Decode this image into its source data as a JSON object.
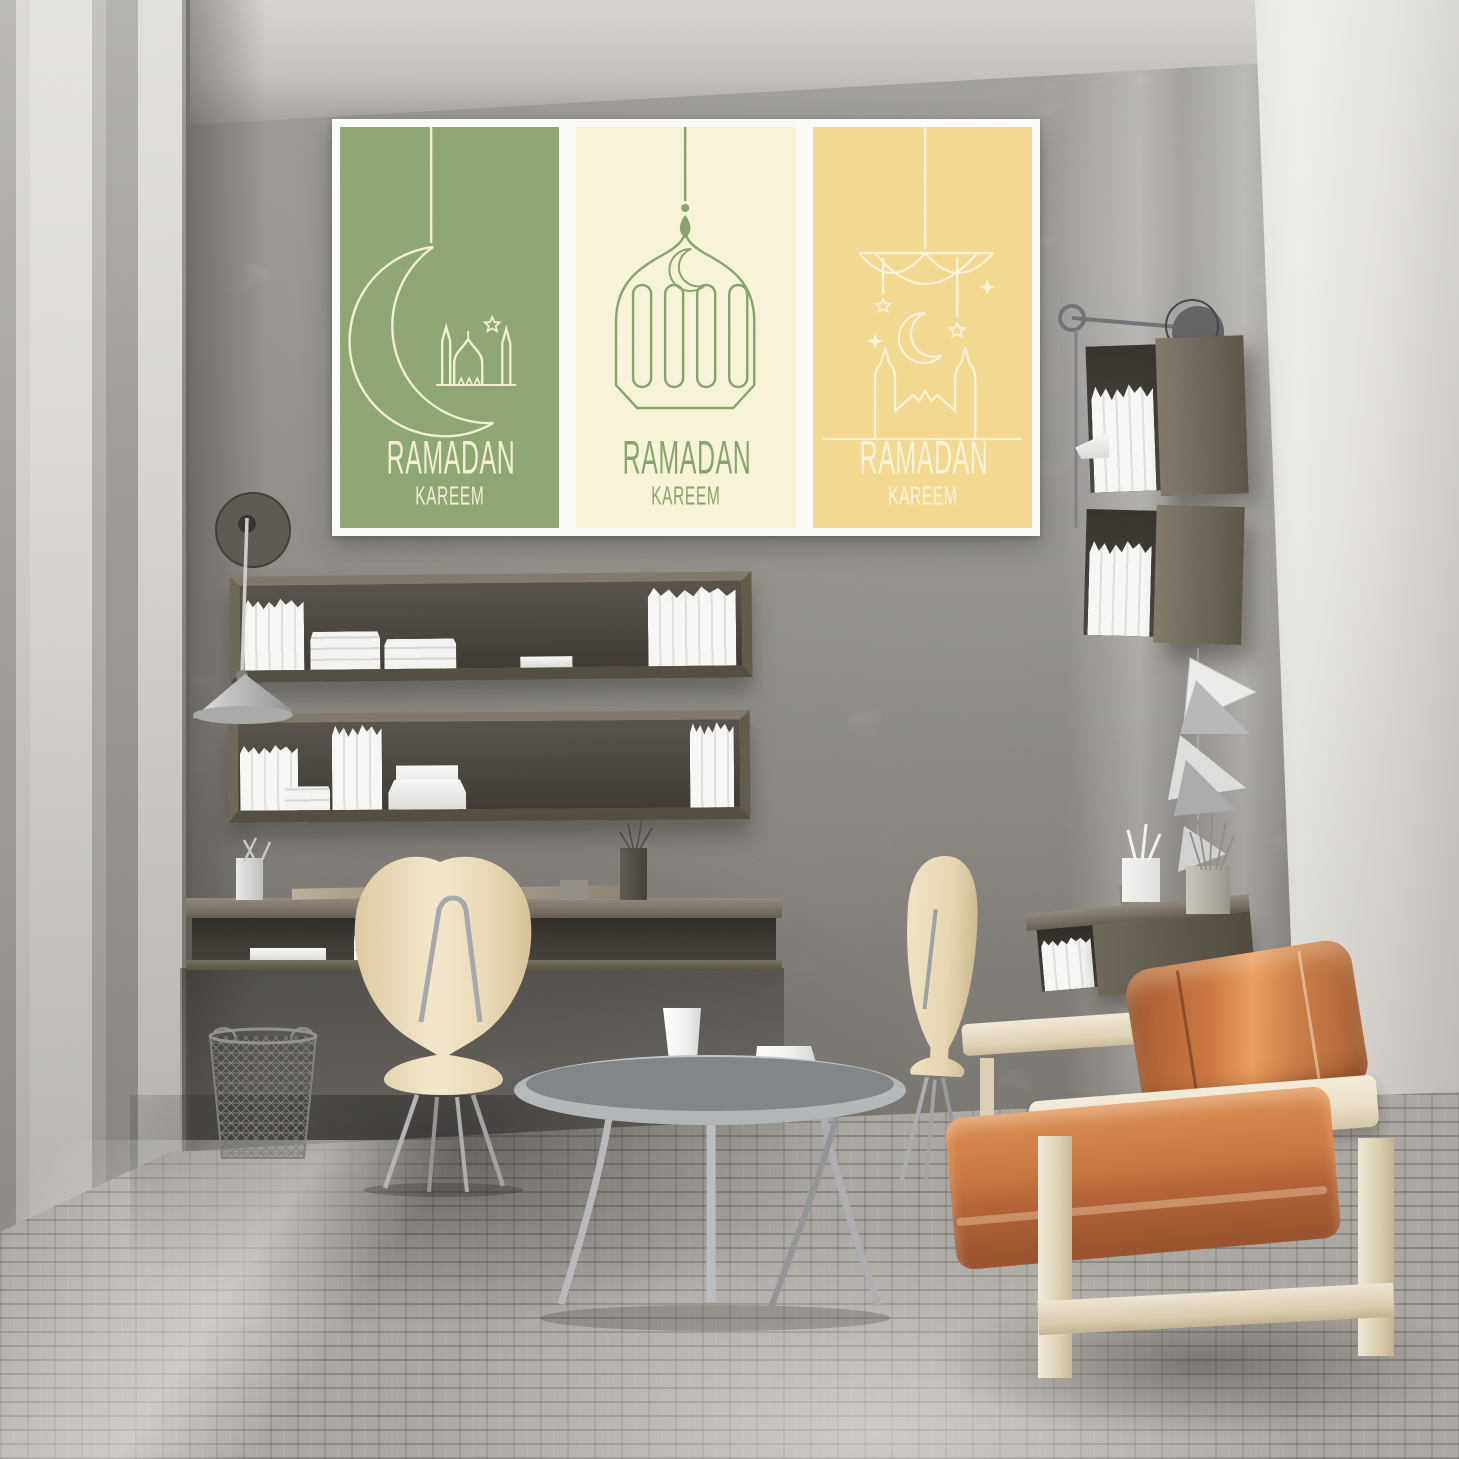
{
  "scene": {
    "type": "3d-interior-render",
    "description": "Sunlit concrete-walled home office and lounge decorated with a three-panel Ramadan Kareem poster, floating wood shelves full of white books, two floating desks, cream molded chairs, a round grey tray coffee table with white vases, box shelves, paper wall sculptures and a cognac leather sofa on a cream wood frame."
  },
  "poster": {
    "frame_color": "#fafaf7",
    "panels": [
      {
        "name": "green-panel",
        "background": "#8ca471",
        "art_color": "#f2efd3",
        "motif": "hanging crescent moon with mosque silhouette and star",
        "title": "RAMADAN",
        "subtitle": "KAREEM"
      },
      {
        "name": "cream-panel",
        "background": "#f7f3d6",
        "art_color": "#84a169",
        "motif": "hanging arabic lantern with crescent moon",
        "title": "RAMADAN",
        "subtitle": "KAREEM"
      },
      {
        "name": "yellow-panel",
        "background": "#f3d78d",
        "art_color": "#fbf4da",
        "motif": "hanging mobile with stars, crescent and mosque skyline",
        "title": "RAMADAN",
        "subtitle": "KAREEM"
      }
    ]
  },
  "palette": {
    "wall_back": "#a19d98",
    "wall_left_light": "#dcd9d5",
    "wall_right_bright": "#eceae6",
    "ceiling": "#c9c6c1",
    "floor": "#a8a4a0",
    "poster_frame": "#fafaf7",
    "wood_dark": "#6e6759",
    "wood_interior": "#403c35",
    "book_white": "#f5f5f3",
    "chair_cream": "#e9dab4",
    "sofa_frame": "#ede4d0",
    "leather": "#c06a3a",
    "leather_light": "#e2935c",
    "leather_dark": "#8a4a28",
    "metal": "#aeb0b2",
    "metal_dark": "#5c5e60"
  },
  "furniture": {
    "poster": {
      "label": "Ramadan Kareem triptych poster"
    },
    "left_sconce": {
      "label": "wall sconce with metal cone shade"
    },
    "shelf_upper": {
      "label": "floating wood shelf with white books"
    },
    "shelf_lower": {
      "label": "floating wood shelf with white books and boxes"
    },
    "left_desk": {
      "label": "floating wall desk with pen cup, scissors and folders"
    },
    "wire_basket": {
      "label": "wire mesh waste basket"
    },
    "left_chair": {
      "label": "cream molded chair with hairpin metal legs"
    },
    "coffee_table": {
      "label": "round grey tray coffee table with three white vases"
    },
    "right_chair": {
      "label": "cream molded side chair"
    },
    "right_desk": {
      "label": "floating wall desk with books, planter and brush pot"
    },
    "box_shelf_upper": {
      "label": "wall box shelf with white books and papers"
    },
    "box_shelf_lower": {
      "label": "wall box shelf with white books"
    },
    "right_lamp": {
      "label": "swing-arm disc wall lamp"
    },
    "sculptures": {
      "label": "folded paper triangle wall sculptures"
    },
    "sofa": {
      "label": "cream wood frame sofa with cognac leather cushions"
    }
  }
}
